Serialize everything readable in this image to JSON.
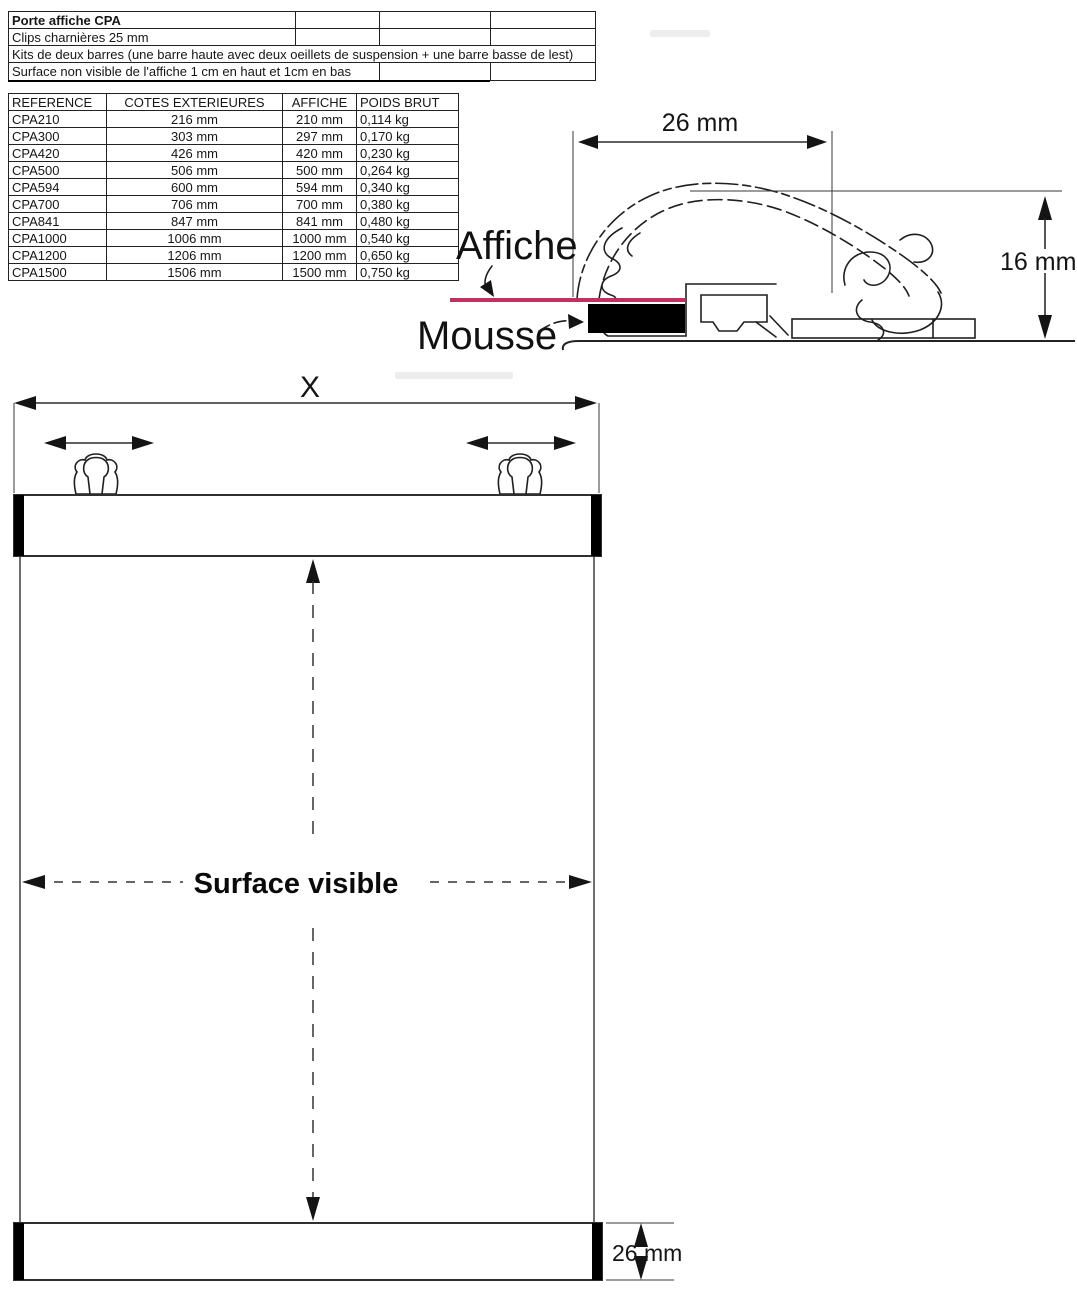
{
  "info_table": {
    "rows": [
      {
        "title": "Porte affiche CPA"
      },
      {
        "title": "Clips charnières 25 mm"
      },
      {
        "title": "Kits de deux barres (une barre haute avec deux oeillets de suspension + une barre basse de lest)"
      },
      {
        "title": "Surface non visible de l'affiche 1 cm en haut et 1cm en bas"
      }
    ]
  },
  "spec_table": {
    "headers": [
      "REFERENCE",
      "COTES EXTERIEURES",
      "AFFICHE",
      "POIDS BRUT"
    ],
    "rows": [
      [
        "CPA210",
        "216 mm",
        "210 mm",
        "0,114 kg"
      ],
      [
        "CPA300",
        "303 mm",
        "297 mm",
        "0,170 kg"
      ],
      [
        "CPA420",
        "426 mm",
        "420 mm",
        "0,230 kg"
      ],
      [
        "CPA500",
        "506 mm",
        "500 mm",
        "0,264 kg"
      ],
      [
        "CPA594",
        "600 mm",
        "594 mm",
        "0,340 kg"
      ],
      [
        "CPA700",
        "706 mm",
        "700 mm",
        "0,380 kg"
      ],
      [
        "CPA841",
        "847 mm",
        "841 mm",
        "0,480 kg"
      ],
      [
        "CPA1000",
        "1006 mm",
        "1000 mm",
        "0,540 kg"
      ],
      [
        "CPA1200",
        "1206 mm",
        "1200 mm",
        "0,650 kg"
      ],
      [
        "CPA1500",
        "1506 mm",
        "1500 mm",
        "0,750 kg"
      ]
    ]
  },
  "cross_section": {
    "width_label": "26 mm",
    "height_label": "16 mm",
    "poster_label": "Affiche",
    "foam_label": "Mousse",
    "poster_color": "#bf3160",
    "foam_color": "#000000"
  },
  "front_view": {
    "width_label": "X",
    "surface_label": "Surface visible",
    "bar_height_label": "26 mm"
  }
}
